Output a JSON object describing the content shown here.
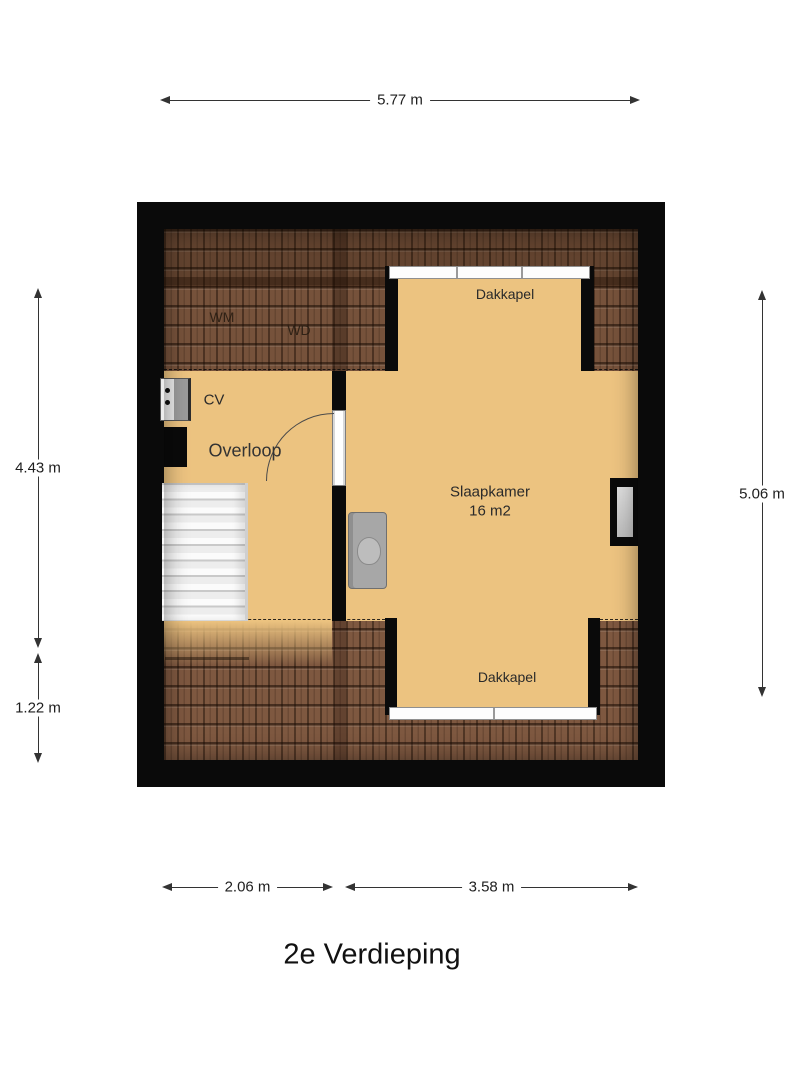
{
  "title": "2e Verdieping",
  "dimensions": {
    "top": "5.77 m",
    "left_upper": "4.43 m",
    "left_lower": "1.22 m",
    "right": "5.06 m",
    "bottom_left": "2.06 m",
    "bottom_right": "3.58 m"
  },
  "rooms": {
    "bedroom": {
      "label": "Slaapkamer",
      "area": "16 m2"
    },
    "landing": {
      "label": "Overloop"
    },
    "dormer_top": {
      "label": "Dakkapel"
    },
    "dormer_bottom": {
      "label": "Dakkapel"
    },
    "boiler": {
      "label": "CV"
    },
    "washing_machine": {
      "label": "WM"
    },
    "dryer": {
      "label": "WD"
    }
  },
  "colors": {
    "floor": "#ecc380",
    "wall": "#0a0a0a",
    "roof_base": "#7e5840",
    "roof_top_band": "#76523b",
    "dimension_line": "#333333"
  }
}
